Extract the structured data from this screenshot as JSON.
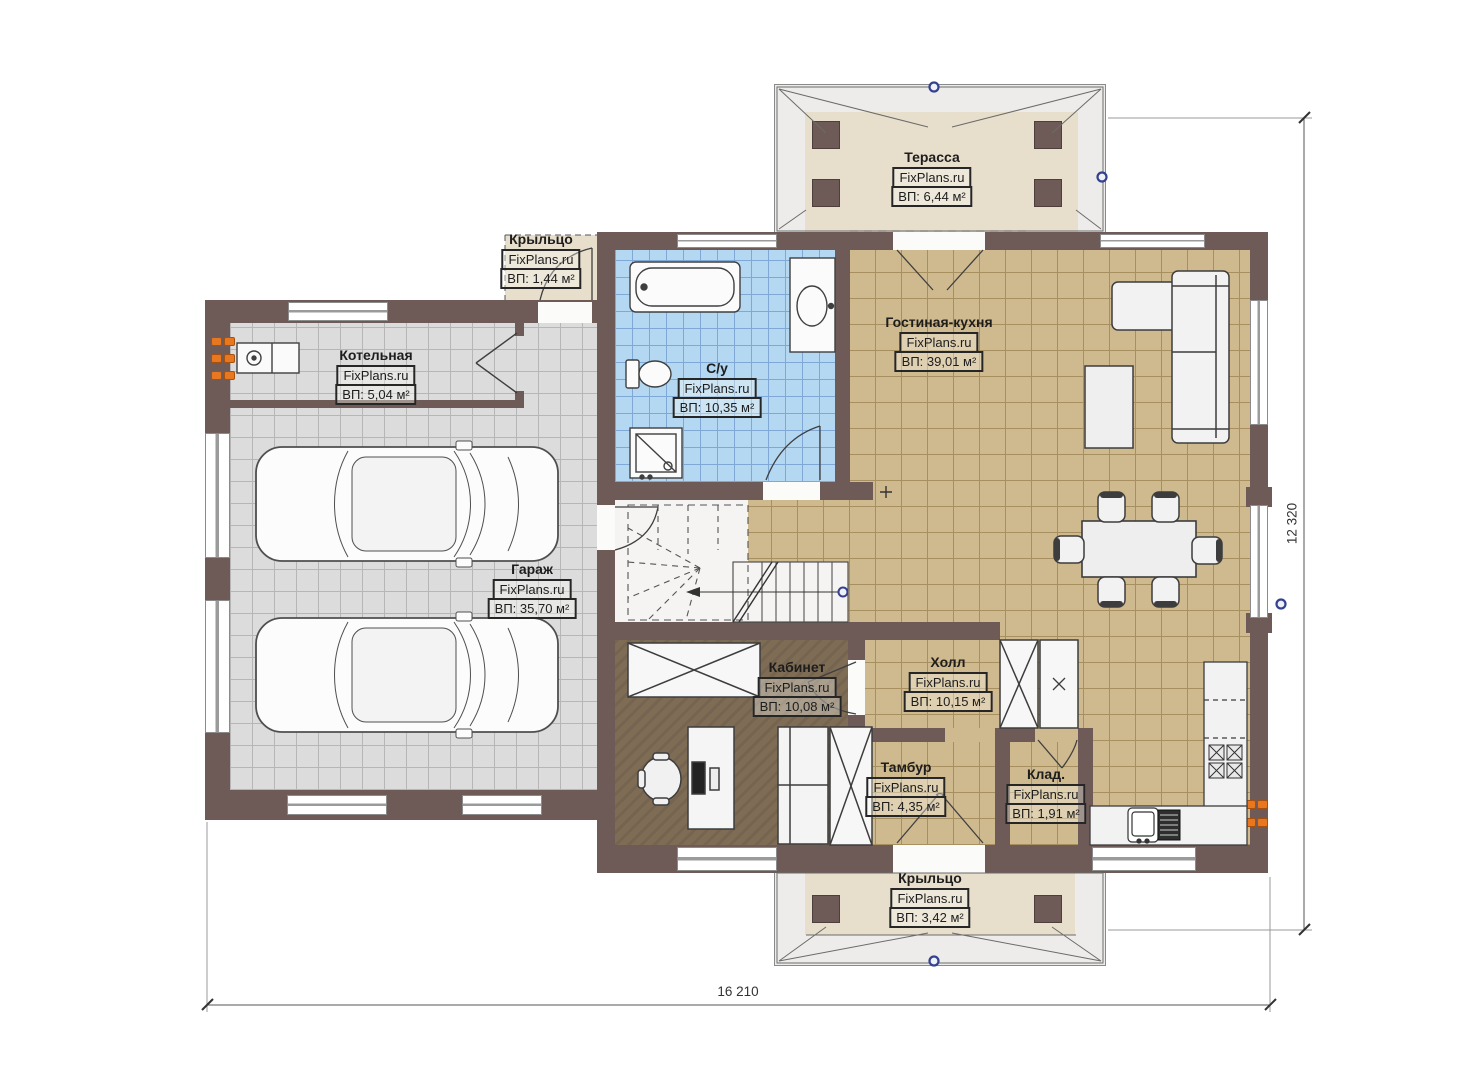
{
  "watermark": "FixPlans.ru",
  "rooms": [
    {
      "key": "terrace",
      "name": "Терасса",
      "brand": "FixPlans.ru",
      "area": "ВП: 6,44 м²"
    },
    {
      "key": "porch-top",
      "name": "Крыльцо",
      "brand": "FixPlans.ru",
      "area": "ВП: 1,44 м²"
    },
    {
      "key": "boiler",
      "name": "Котельная",
      "brand": "FixPlans.ru",
      "area": "ВП: 5,04 м²"
    },
    {
      "key": "bathroom",
      "name": "С/у",
      "brand": "FixPlans.ru",
      "area": "ВП: 10,35 м²"
    },
    {
      "key": "living-kitchen",
      "name": "Гостиная-кухня",
      "brand": "FixPlans.ru",
      "area": "ВП: 39,01 м²"
    },
    {
      "key": "garage",
      "name": "Гараж",
      "brand": "FixPlans.ru",
      "area": "ВП: 35,70 м²"
    },
    {
      "key": "office",
      "name": "Кабинет",
      "brand": "FixPlans.ru",
      "area": "ВП: 10,08 м²"
    },
    {
      "key": "hall",
      "name": "Холл",
      "brand": "FixPlans.ru",
      "area": "ВП: 10,15 м²"
    },
    {
      "key": "vestibule",
      "name": "Тамбур",
      "brand": "FixPlans.ru",
      "area": "ВП: 4,35 м²"
    },
    {
      "key": "storage",
      "name": "Клад.",
      "brand": "FixPlans.ru",
      "area": "ВП: 1,91 м²"
    },
    {
      "key": "porch-bottom",
      "name": "Крыльцо",
      "brand": "FixPlans.ru",
      "area": "ВП: 3,42 м²"
    }
  ],
  "dimensions": {
    "bottom": "16 210",
    "right": "12 320"
  },
  "colors": {
    "wall": "#6e5b57",
    "floor_tile_gray": "#dcdcdc",
    "floor_tile_blue": "#b4d7f2",
    "floor_tile_tan": "#cfb98e",
    "floor_wood": "#7e6c55",
    "floor_porch": "#e7decb",
    "roof_band": "#edecea",
    "indicator_orange": "#e8771f",
    "axis_marker_blue": "#34418e"
  }
}
